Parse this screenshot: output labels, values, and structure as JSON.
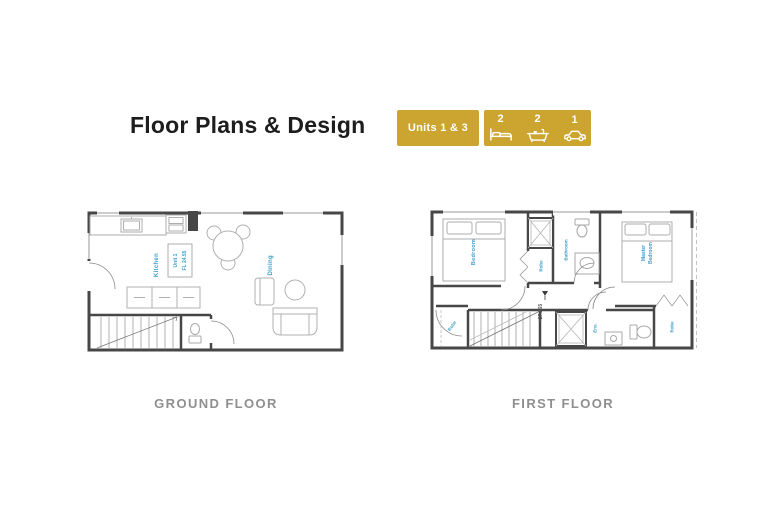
{
  "title": "Floor Plans & Design",
  "badges": {
    "units": {
      "label": "Units 1 & 3"
    },
    "features": {
      "items": [
        {
          "count": "2",
          "icon": "bed-icon"
        },
        {
          "count": "2",
          "icon": "bath-icon"
        },
        {
          "count": "1",
          "icon": "car-icon"
        }
      ]
    }
  },
  "ground_floor": {
    "caption": "GROUND FLOOR",
    "labels": {
      "kitchen": "Kitchen",
      "lounge_dining": "Lounge / Dining",
      "unit_line1": "Unit 1",
      "unit_line2": "FL 24.55"
    }
  },
  "first_floor": {
    "caption": "FIRST FLOOR",
    "labels": {
      "bedroom": "Bedroom",
      "robe_top": "Robe",
      "bathroom": "Bathroom",
      "master_line1": "Master",
      "master_line2": "Bedroom",
      "level": "+27.265",
      "robe_left": "Robe",
      "ensuite": "Ens.",
      "robe_right": "Robe"
    }
  },
  "colors": {
    "badge_gold": "#cba52f",
    "plan_label_blue": "#3e9ec9",
    "wall_dark": "#474747",
    "caption_gray": "#8f8f8f"
  }
}
